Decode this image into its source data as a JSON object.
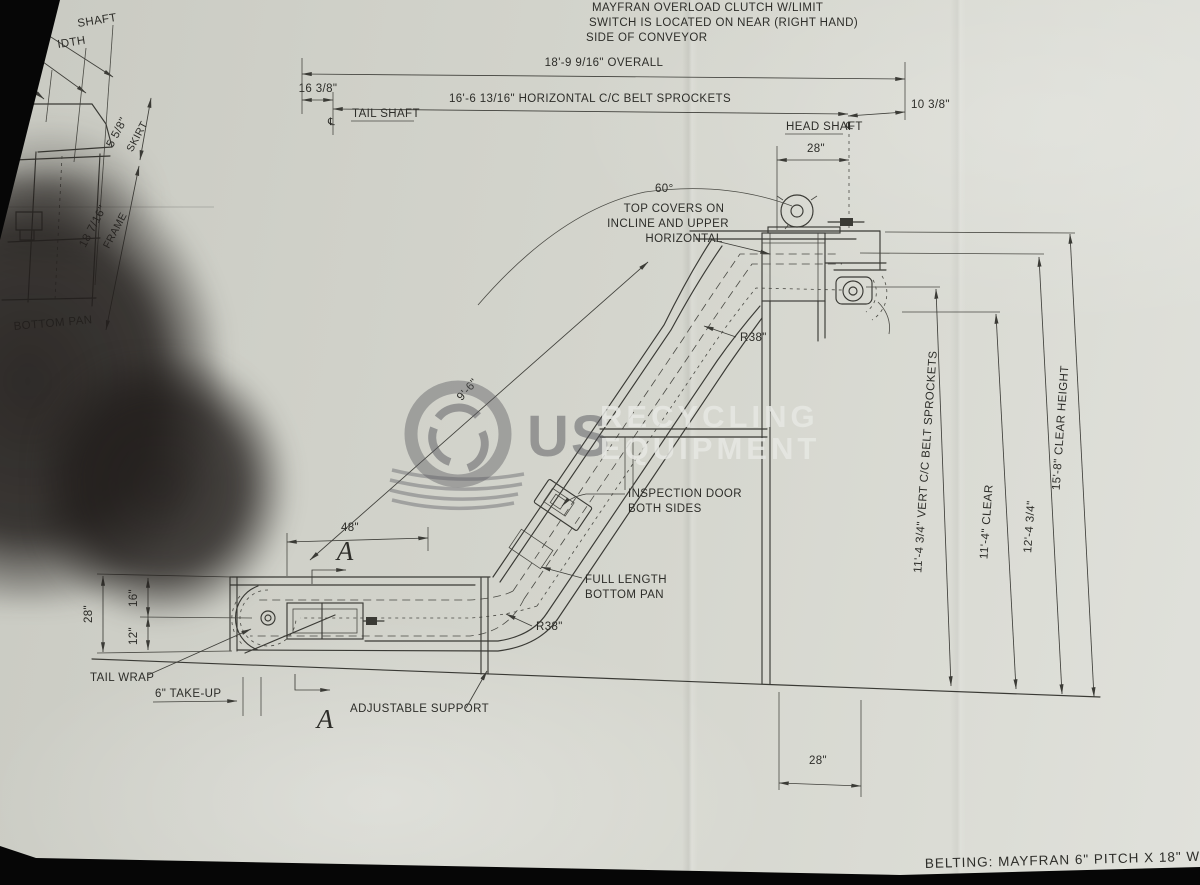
{
  "colors": {
    "paper": "#d5d6ce",
    "ink": "#32322e",
    "photo_edge": "#060606",
    "watermark_dark": "#55555a",
    "watermark_light": "#e4e5e1"
  },
  "note": {
    "l1": "MAYFRAN OVERLOAD CLUTCH W/LIMIT",
    "l2": "SWITCH IS LOCATED ON NEAR (RIGHT HAND)",
    "l3": "SIDE OF CONVEYOR"
  },
  "dims": {
    "overall": "18'-9 9/16\" OVERALL",
    "tail_offset": "16 3/8\"",
    "horizontal_cc": "16'-6 13/16\" HORIZONTAL C/C BELT SPROCKETS",
    "head_offset": "10 3/8\"",
    "top_28": "28\"",
    "angle": "60°",
    "incline_length": "9'-6\"",
    "r38_upper": "R38\"",
    "r38_lower": "R38\"",
    "dim_48": "48\"",
    "left_28": "28\"",
    "left_16": "16\"",
    "left_12": "12\"",
    "take_up": "6\" TAKE-UP",
    "vert_cc": "11'-4 3/4\" VERT C/C BELT SPROCKETS",
    "clear_11": "11'-4\" CLEAR",
    "height_12": "12'-4 3/4\"",
    "clear_height": "15'-8\" CLEAR HEIGHT",
    "bottom_28": "28\""
  },
  "labels": {
    "tail_shaft": "TAIL SHAFT",
    "head_shaft": "HEAD SHAFT",
    "centerline": "℄",
    "top_covers_1": "TOP COVERS ON",
    "top_covers_2": "INCLINE AND UPPER",
    "top_covers_3": "HORIZONTAL",
    "inspection_1": "INSPECTION DOOR",
    "inspection_2": "BOTH SIDES",
    "full_length_1": "FULL LENGTH",
    "full_length_2": "BOTTOM PAN",
    "tail_wrap": "TAIL WRAP",
    "adjustable_support": "ADJUSTABLE SUPPORT",
    "section_a": "A"
  },
  "end_view": {
    "shaft": "SHAFT",
    "width": "IDTH",
    "skirts": "RTS",
    "skirt_dim": "5 5/8\"",
    "skirt": "SKIRT",
    "frame_dim": "18 7/16\"",
    "frame": "FRAME",
    "bottom_pan": "BOTTOM PAN"
  },
  "watermark": {
    "us": "US",
    "recycling": "RECYCLING",
    "equipment": "EQUIPMENT"
  },
  "footer": {
    "belting": "BELTING: MAYFRAN 6\" PITCH X 18\" WIDE STEEL"
  }
}
